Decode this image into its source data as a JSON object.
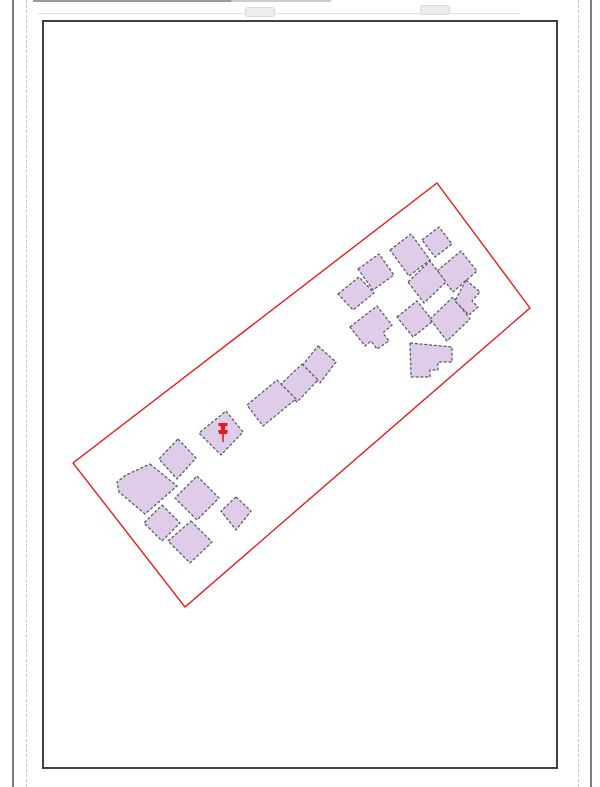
{
  "window": {
    "width": 600,
    "height": 787,
    "background": "#ffffff"
  },
  "layout_view": {
    "page_edge_left_x": 12,
    "page_edge_right_x": 590,
    "margin_guide_left_x": 26,
    "margin_guide_right_x": 578,
    "edge_color": "#7c7c7c",
    "margin_color": "#c6c6c6",
    "top_artifacts": {
      "dark_segment": {
        "x": 33,
        "y": 0,
        "w": 198,
        "h": 2,
        "color": "#9a9a9a"
      },
      "light_segment": {
        "x": 231,
        "y": 0,
        "w": 100,
        "h": 2,
        "color": "#cccccc"
      },
      "hairline": {
        "x": 38,
        "y": 13,
        "w": 482,
        "h": 1,
        "color": "#e2e2e2"
      },
      "handle1": {
        "x": 245,
        "y": 7,
        "w": 28,
        "h": 8
      },
      "handle2": {
        "x": 420,
        "y": 5,
        "w": 28,
        "h": 8
      },
      "handle_color": "#ededed",
      "handle_border": "#d8d8d8"
    },
    "map_frame": {
      "x": 42,
      "y": 20,
      "w": 516,
      "h": 749,
      "border_color": "#3f4144",
      "border_width": 2,
      "fill": "#ffffff"
    }
  },
  "map": {
    "parcel_boundary": {
      "stroke": "#f40b0b",
      "stroke_width": 1.3,
      "points": "73,463 437,183 530,308 185,607"
    },
    "buildings": {
      "fill": "#decce9",
      "stroke": "#55555e",
      "stroke_width": 1.2,
      "dash": "3 1.8",
      "polygons": [
        "422,240 439,227 452,244 435,257",
        "390,250 411,234 430,260 409,276",
        "437,271 461,251 477,271 453,292",
        "408,282 430,261 446,282 424,303",
        "358,269 379,254 394,275 373,290",
        "338,294 359,277 374,293 353,310",
        "397,317 417,301 433,321 413,337",
        "430,319 453,297 470,319 447,341",
        "466,280 480,292 472,301 478,307 469,315 455,301",
        "350,327 377,306 392,325 383,333 389,341 377,349 371,341 365,346",
        "410,343 452,347 452,362 438,362 438,370 430,370 430,377 411,377",
        "318,346 336,362 320,383 301,367",
        "302,364 318,380 297,402 280,385",
        "277,380 296,399 263,426 247,405",
        "226,411 243,432 221,455 199,433",
        "150,464 177,486 145,514 119,492 117,482 126,475",
        "178,439 196,458 177,479 159,459",
        "197,476 219,498 197,520 175,498",
        "236,497 251,511 236,530 221,511",
        "191,521 212,542 190,563 168,541",
        "162,505 180,523 162,541 144,523"
      ]
    },
    "marker": {
      "shape": "pushpin",
      "color": "#e8191d",
      "cx": 223,
      "cy": 432
    }
  }
}
